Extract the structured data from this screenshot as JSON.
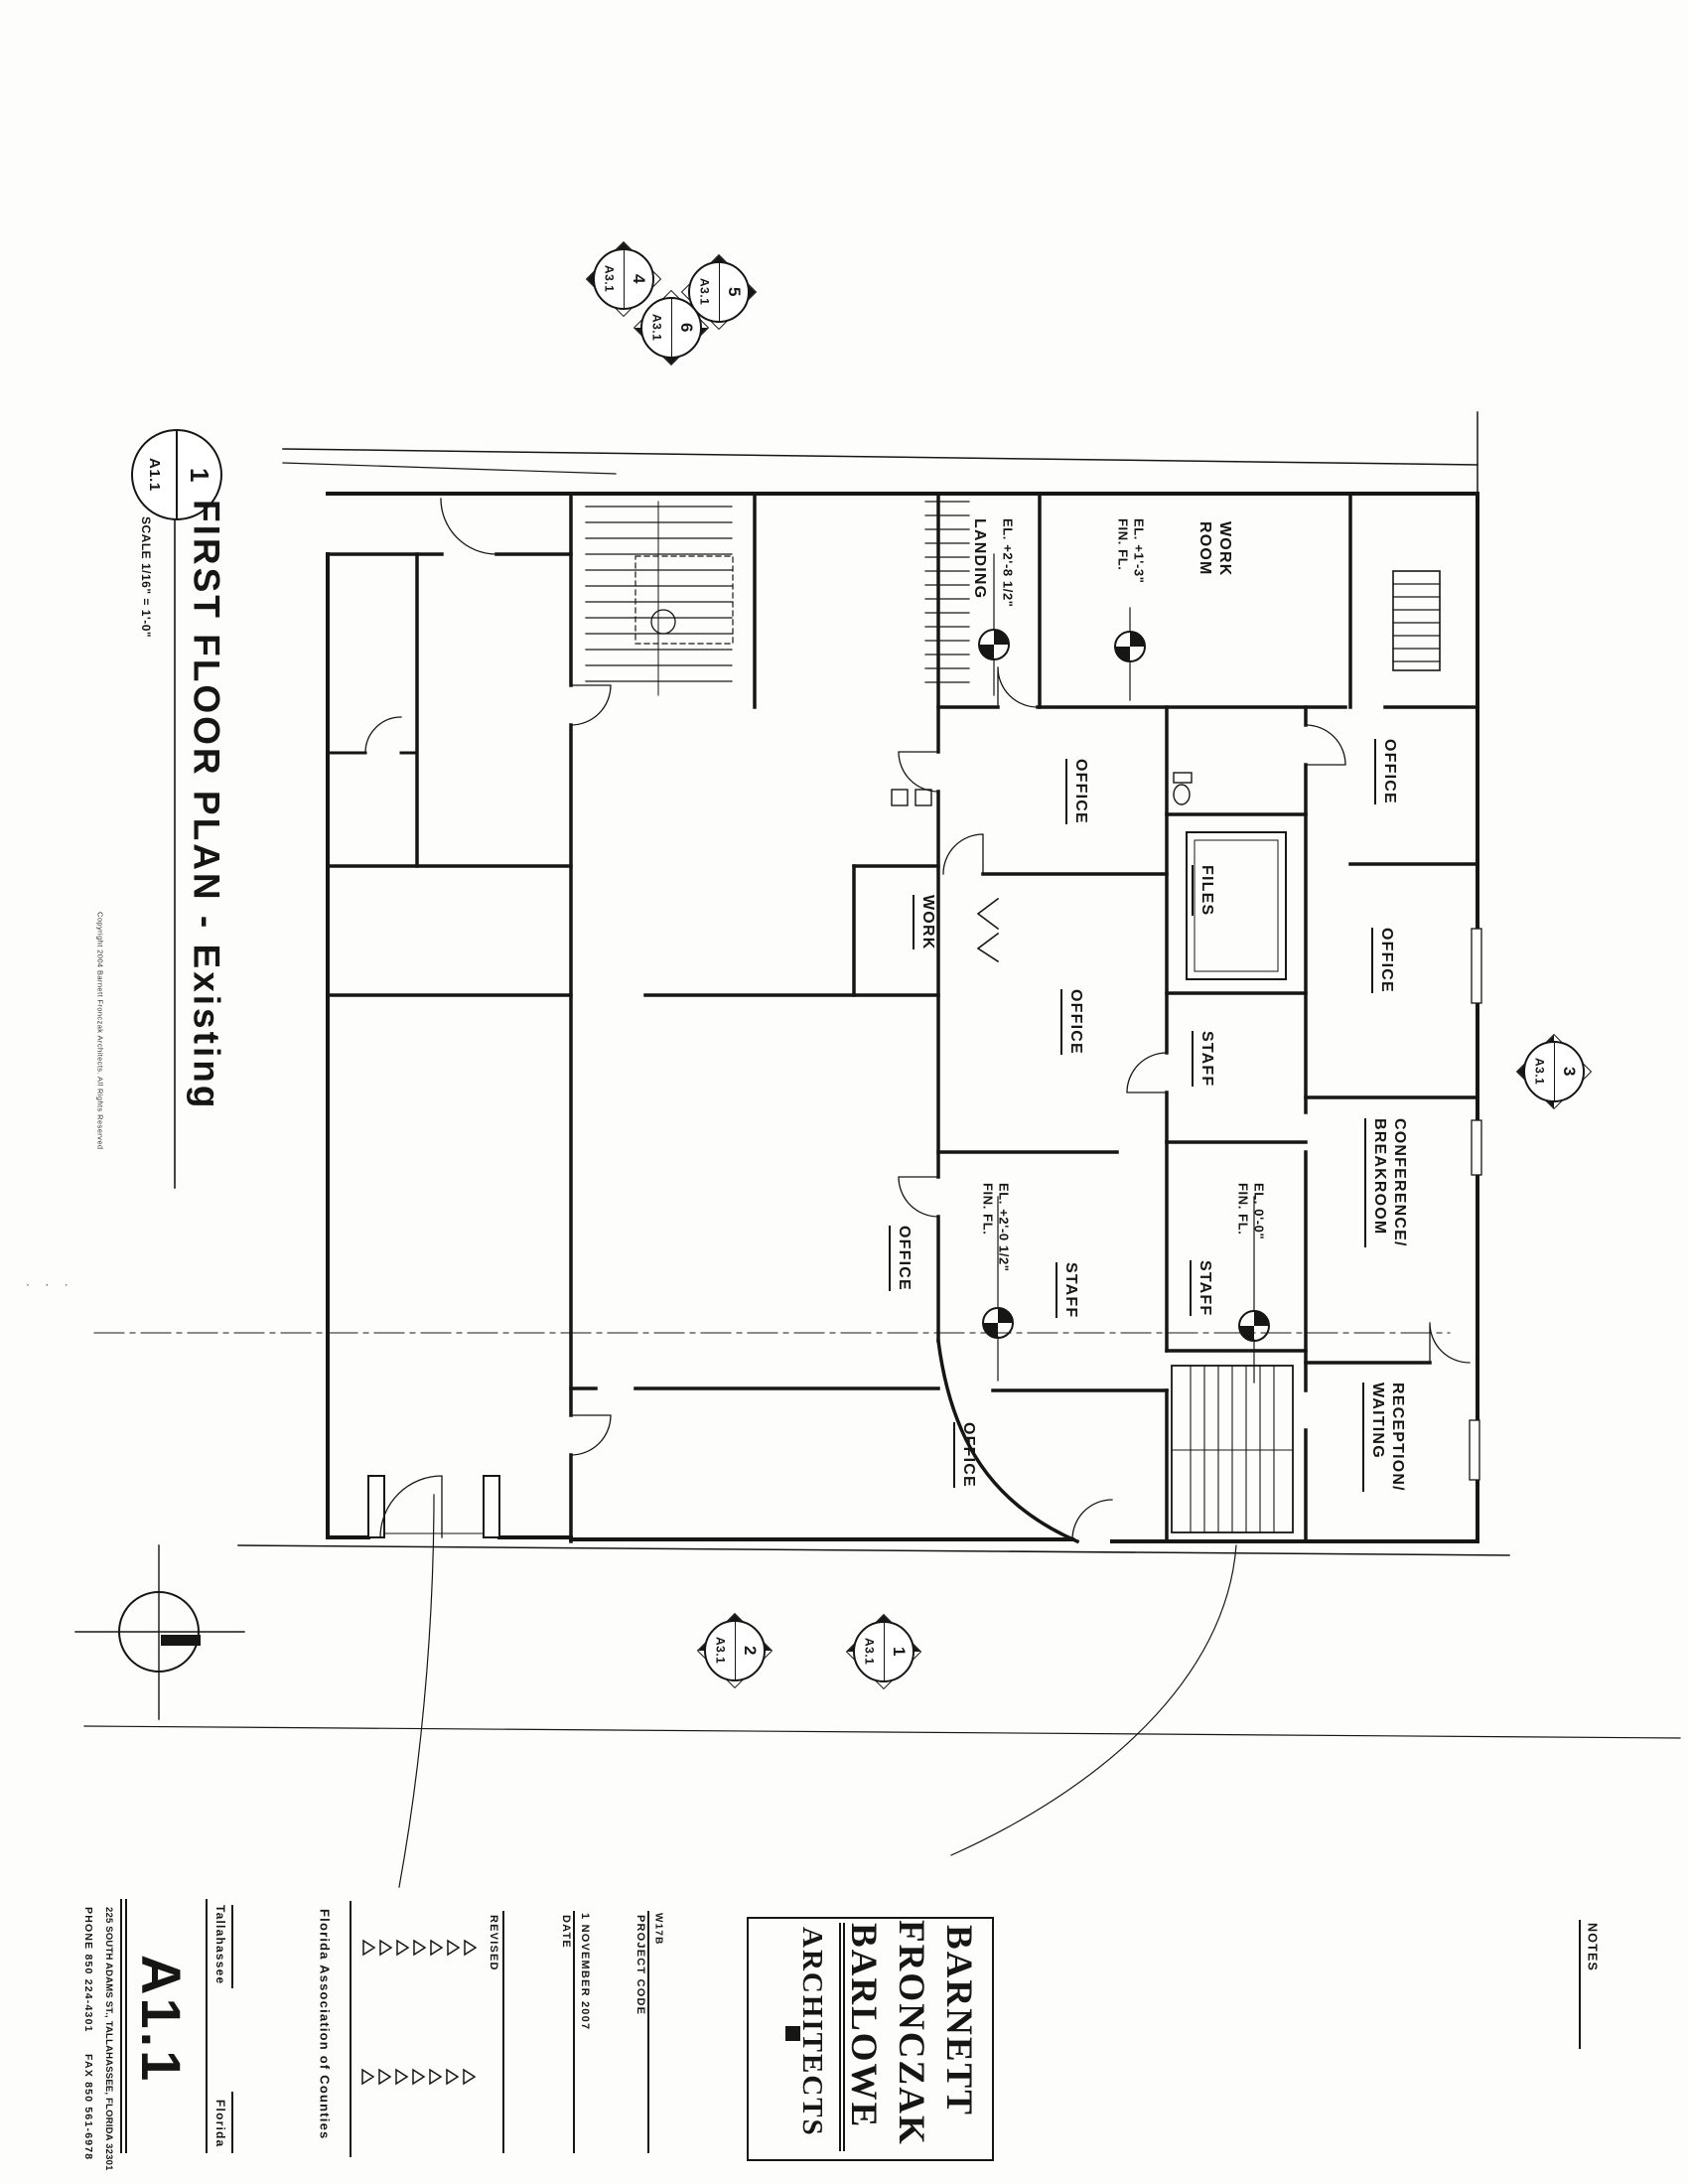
{
  "sheet": {
    "paper_color": "#fdfdfb",
    "ink_color": "#161616"
  },
  "title": {
    "detail_number": "1",
    "sheet_ref": "A1.1",
    "text": "FIRST FLOOR PLAN - Existing",
    "scale": "SCALE 1/16\" = 1'-0\"",
    "copyright": "Copyright 2004 Barnett Fronczak Architects. All Rights Reserved"
  },
  "rooms": [
    {
      "text": "LANDING"
    },
    {
      "text": "WORK\nROOM"
    },
    {
      "text": "OFFICE"
    },
    {
      "text": "OFFICE"
    },
    {
      "text": "WORK"
    },
    {
      "text": "FILES"
    },
    {
      "text": "OFFICE"
    },
    {
      "text": "OFFICE"
    },
    {
      "text": "STAFF"
    },
    {
      "text": "CONFERENCE/\nBREAKROOM"
    },
    {
      "text": "OFFICE"
    },
    {
      "text": "STAFF"
    },
    {
      "text": "STAFF"
    },
    {
      "text": "OFFICE"
    },
    {
      "text": "RECEPTION/\nWAITING"
    }
  ],
  "elevations": [
    {
      "text": "EL. +2'-8 1/2\""
    },
    {
      "text": "EL. +1'-3\"\nFIN. FL."
    },
    {
      "text": "EL. +2'-0 1/2\"\nFIN. FL."
    },
    {
      "text": "EL. 0'-0\"\nFIN. FL."
    }
  ],
  "markers": {
    "top": [
      {
        "num": "4",
        "sheet": "A3.1"
      },
      {
        "num": "5",
        "sheet": "A3.1"
      },
      {
        "num": "6",
        "sheet": "A3.1"
      }
    ],
    "side": {
      "num": "3",
      "sheet": "A3.1"
    },
    "bottom": [
      {
        "num": "2",
        "sheet": "A3.1"
      },
      {
        "num": "1",
        "sheet": "A3.1"
      }
    ]
  },
  "titleblock": {
    "phone": "PHONE 850 224-4301",
    "fax": "FAX 850 561-6978",
    "address": "225 SOUTH ADAMS ST., TALLAHASSEE, FLORIDA 32301",
    "city": "Tallahassee",
    "state": "Florida",
    "sheet_number": "A1.1",
    "client": "Florida Association of Counties",
    "revised_label": "REVISED",
    "date_label": "DATE",
    "date_value": "1 NOVEMBER 2007",
    "project_code_label": "PROJECT CODE",
    "project_code_value": "W17B",
    "notes_label": "NOTES"
  },
  "logo": {
    "line1": "BARNETT",
    "line2": "FRONCZAK",
    "line3": "BARLOWE",
    "sub": "ARCHITECTS"
  },
  "misc": {
    "tick_dots": "· · ·"
  }
}
